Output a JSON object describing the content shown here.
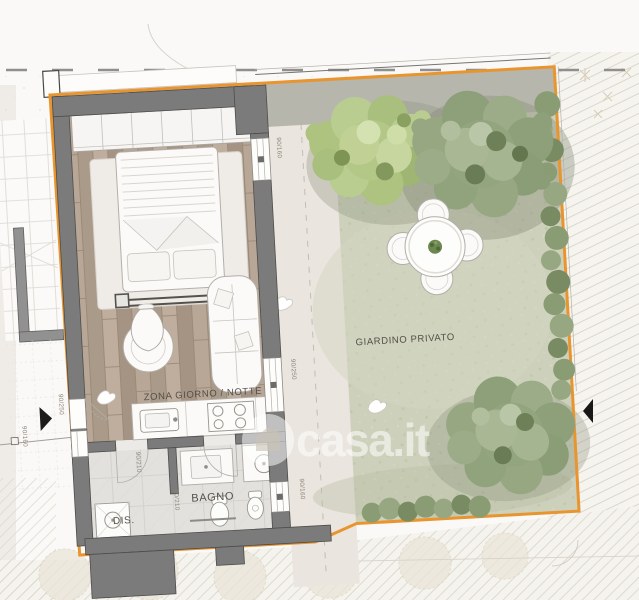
{
  "labels": {
    "living": "ZONA GIORNO / NOTTE",
    "garden": "GIARDINO PRIVATO",
    "bath": "BAGNO",
    "hall": "DIS."
  },
  "dimensions": {
    "bedroom_window": "90/160",
    "living_door": "90/250",
    "bath_window": "90/160",
    "bath_door": "80/210",
    "hall_door": "90/210",
    "left_window": "90/160",
    "entrance_door": "90/250"
  },
  "watermark": {
    "text": "casa.it"
  },
  "colors": {
    "boundary": "#e8952f",
    "walls": "#7b7b7b",
    "grass": "#cdd1bb",
    "wood": "#b2a191",
    "tree_light": "#aec380",
    "tree_dark": "#93a57f"
  }
}
